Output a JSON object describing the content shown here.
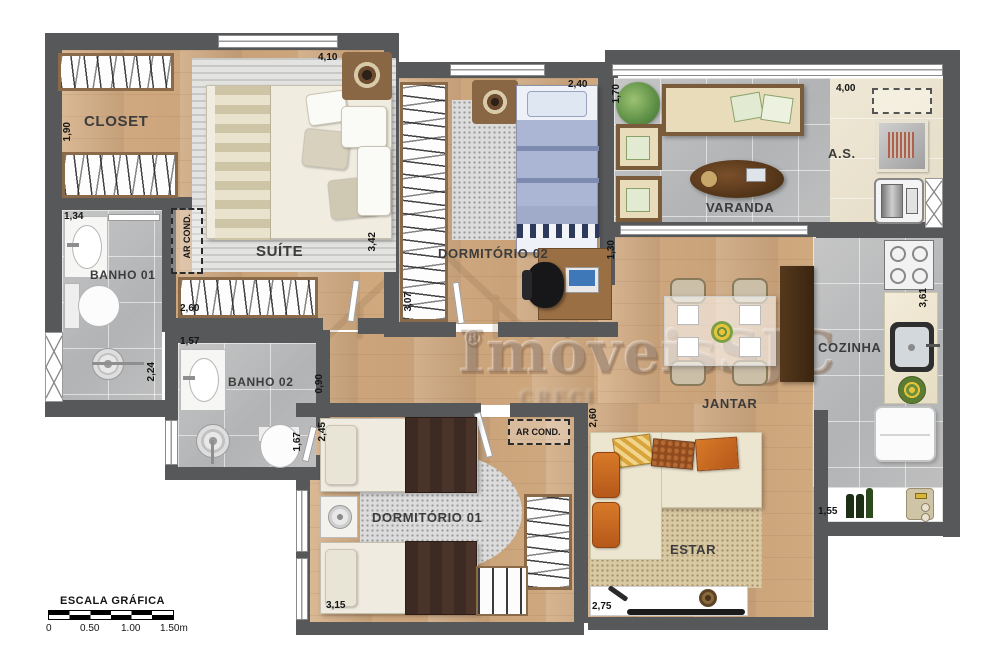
{
  "labels": {
    "closet": "CLOSET",
    "suite": "SUÍTE",
    "banho01": "BANHO 01",
    "banho02": "BANHO 02",
    "dorm02": "DORMITÓRIO 02",
    "varanda": "VARANDA",
    "area_servico": "A.S.",
    "cozinha": "COZINHA",
    "jantar": "JANTAR",
    "dorm01": "DORMITÓRIO 01",
    "estar": "ESTAR",
    "ar_cond": "AR COND."
  },
  "dims": {
    "suite_top": "4,10",
    "dorm02_top": "2,40",
    "varanda_left": "1,70",
    "as_top": "4,00",
    "closet_left": "1,90",
    "banho01_top": "1,34",
    "banho01_right": "2,24",
    "suite_wardrobe": "2,60",
    "suite_right": "3,42",
    "banho02_top": "1,57",
    "dorm02_left": "3,07",
    "hall_left": "0,90",
    "dorm01_left": "2,45",
    "banho02_right": "1,67",
    "jantar_left": "1,30",
    "dorm01_bottom": "3,15",
    "estar_left": "2,60",
    "estar_bottom": "2,75",
    "cozinha_bottom": "1,55",
    "cozinha_right": "3,61"
  },
  "watermark": {
    "brand": "ImóveisSJC",
    "registered": "®",
    "subtext": "CRECI"
  },
  "scale": {
    "title": "ESCALA GRÁFICA",
    "t0": "0",
    "t1": "0.50",
    "t2": "1.00",
    "t3": "1.50m"
  },
  "colors": {
    "wall": "#57585a",
    "wood": "#cfa87f",
    "tile": "#bdbdbd",
    "sofa_orange": "#c2611e"
  }
}
